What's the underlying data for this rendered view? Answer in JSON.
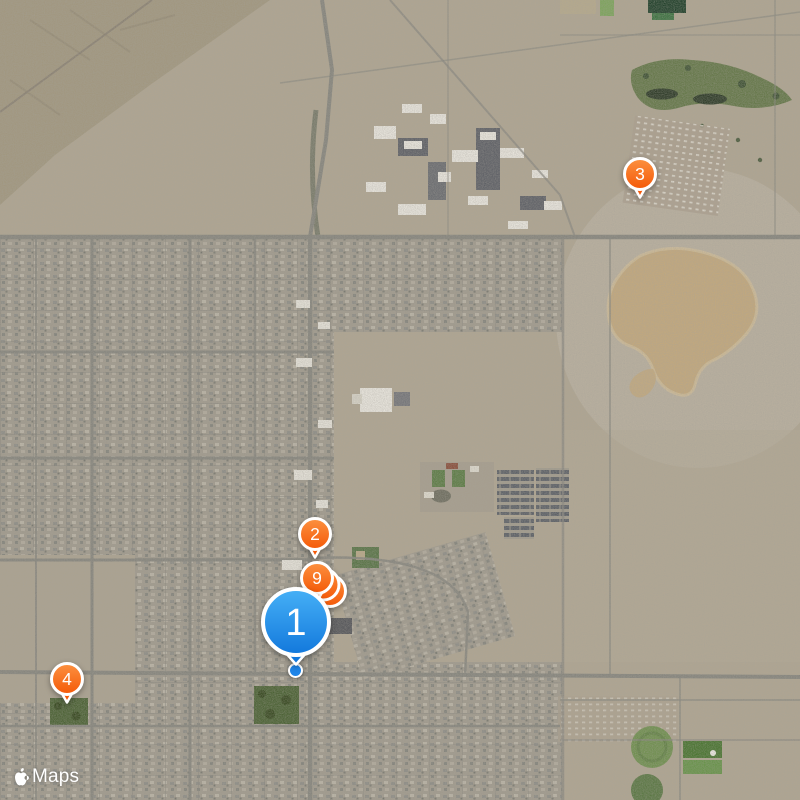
{
  "app": {
    "name": "Maps",
    "view_type": "satellite"
  },
  "attribution": {
    "brand_icon": "apple-logo",
    "label": "Maps"
  },
  "colors": {
    "marker_orange_top": "#fc9140",
    "marker_orange_bottom": "#f45908",
    "marker_blue_top": "#46b0f6",
    "marker_blue_bottom": "#1278dc",
    "marker_outline": "#ffffff",
    "marker_text": "#ffffff",
    "location_dot": "#1e85e9"
  },
  "markers": [
    {
      "id": "2",
      "label": "2",
      "style": "orange",
      "size": "small",
      "stack": 1,
      "x": 315,
      "y": 557
    },
    {
      "id": "9",
      "label": "9",
      "style": "orange",
      "size": "small",
      "stack": 3,
      "x": 317,
      "y": 601
    },
    {
      "id": "3",
      "label": "3",
      "style": "orange",
      "size": "small",
      "stack": 1,
      "x": 640,
      "y": 197
    },
    {
      "id": "4",
      "label": "4",
      "style": "orange",
      "size": "small",
      "stack": 1,
      "x": 67,
      "y": 702
    },
    {
      "id": "1",
      "label": "1",
      "style": "blue",
      "size": "large",
      "stack": 1,
      "x": 296,
      "y": 664
    }
  ],
  "location_dot": {
    "x": 296,
    "y": 671
  }
}
